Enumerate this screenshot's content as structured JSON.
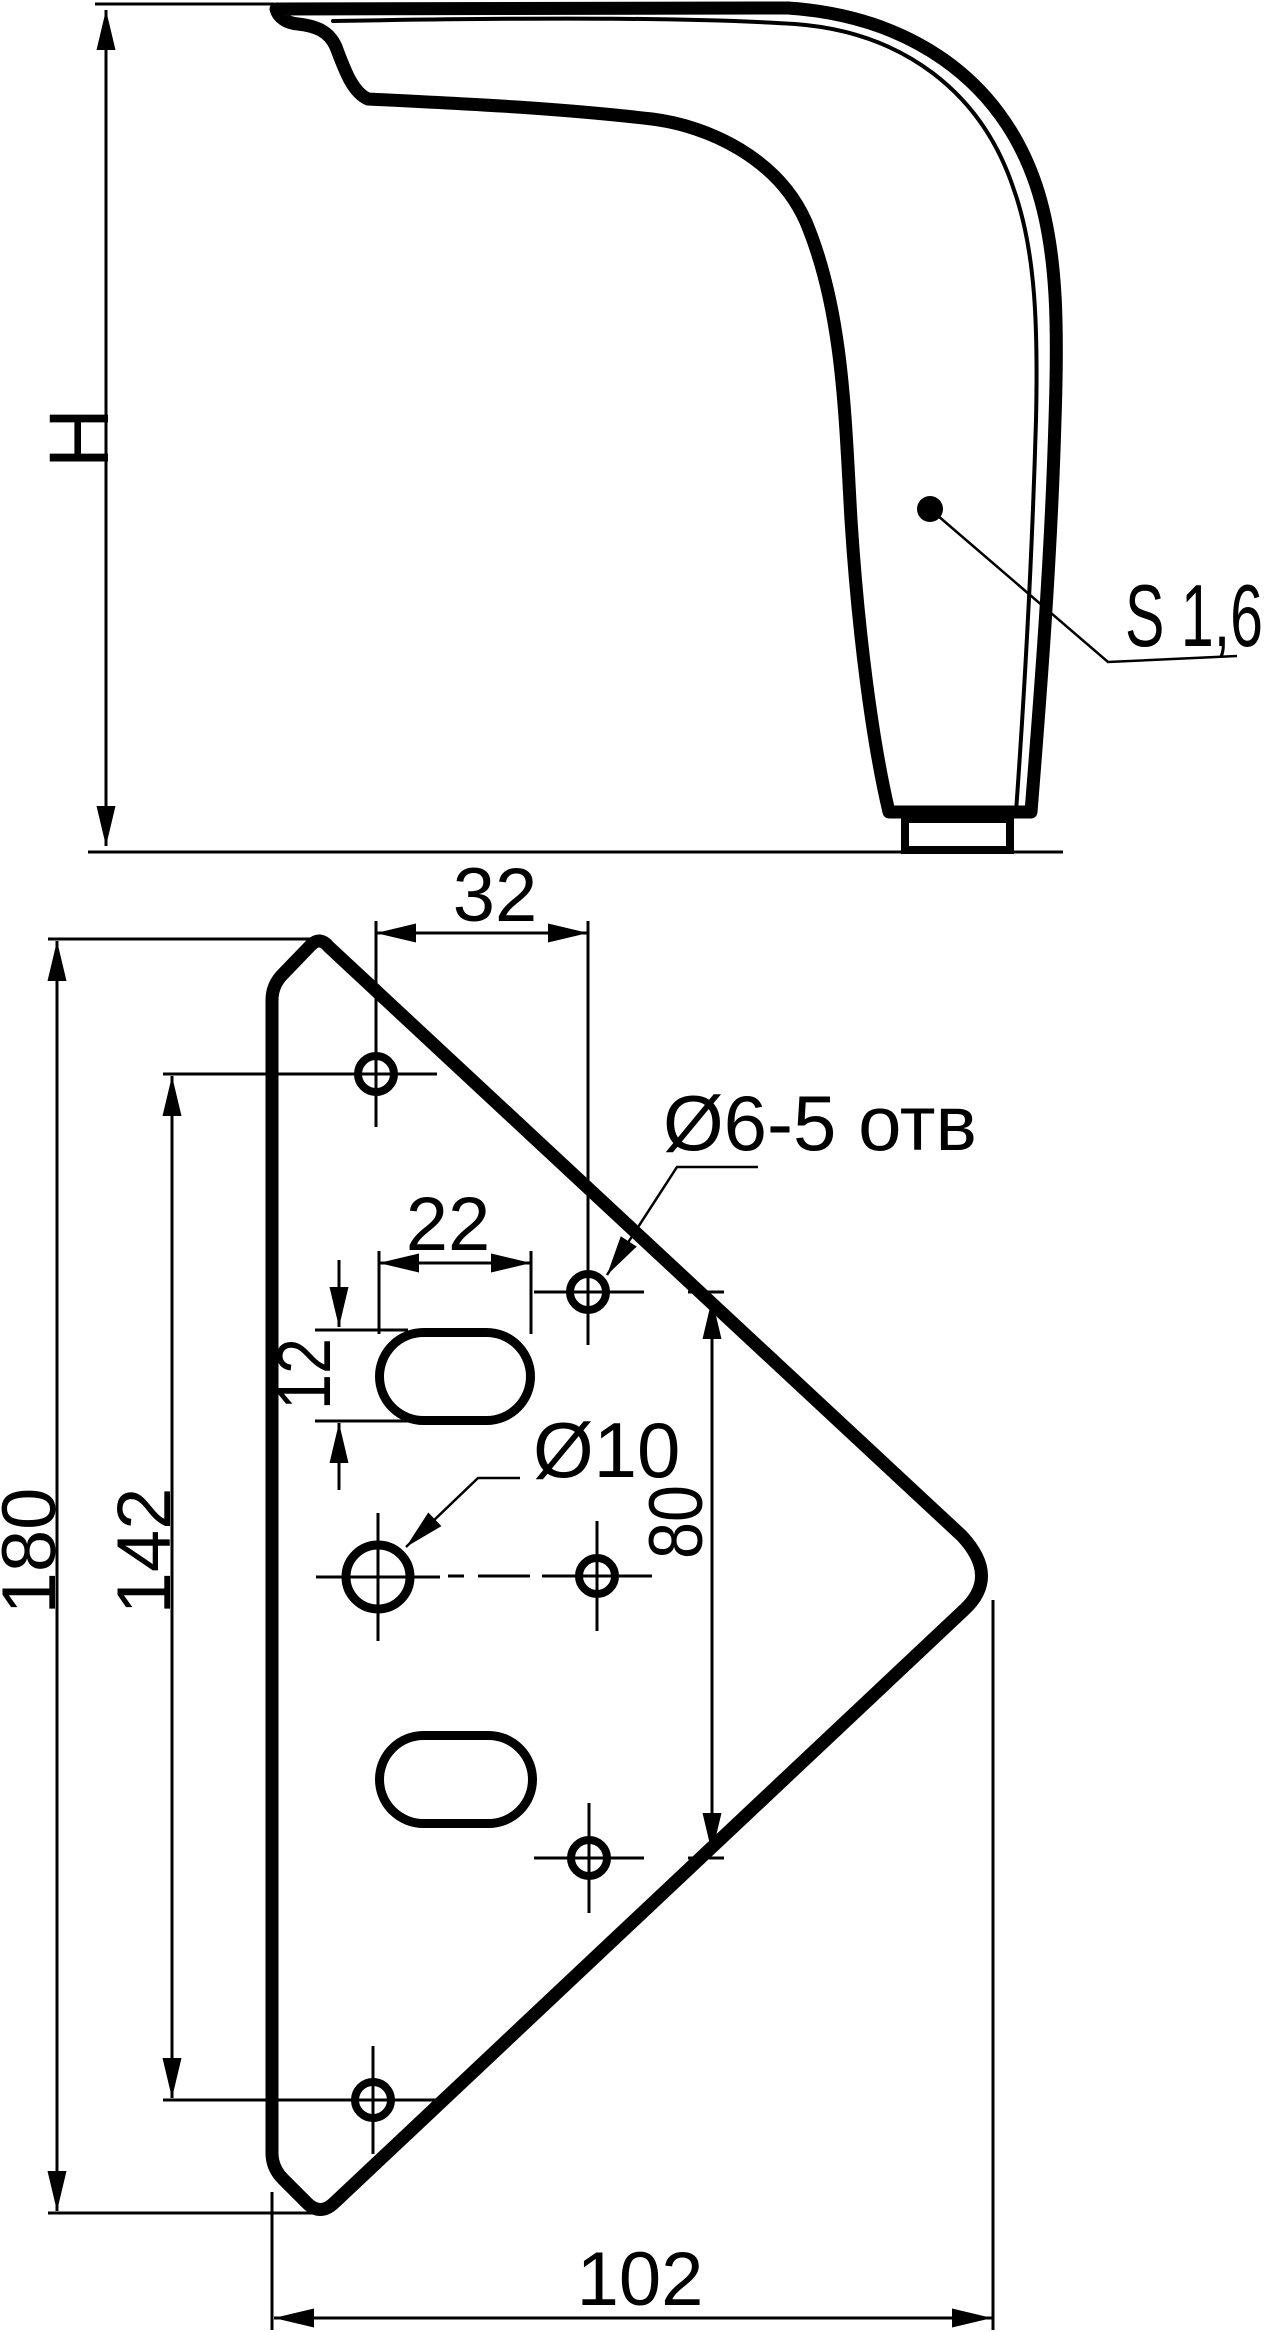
{
  "side_view": {
    "height_label": "H",
    "thickness_label": "S 1,6"
  },
  "plate_view": {
    "dim_hole_columns_offset": "32",
    "dim_slot_length": "22",
    "dim_slot_width": "12",
    "dim_right_holes_span": "80",
    "dim_left_holes_span": "142",
    "dim_total_height": "180",
    "dim_total_width": "102",
    "label_small_holes": "Ø6-5 отв",
    "label_center_hole": "Ø10"
  },
  "colors": {
    "ink": "#000000",
    "paper": "#ffffff"
  }
}
